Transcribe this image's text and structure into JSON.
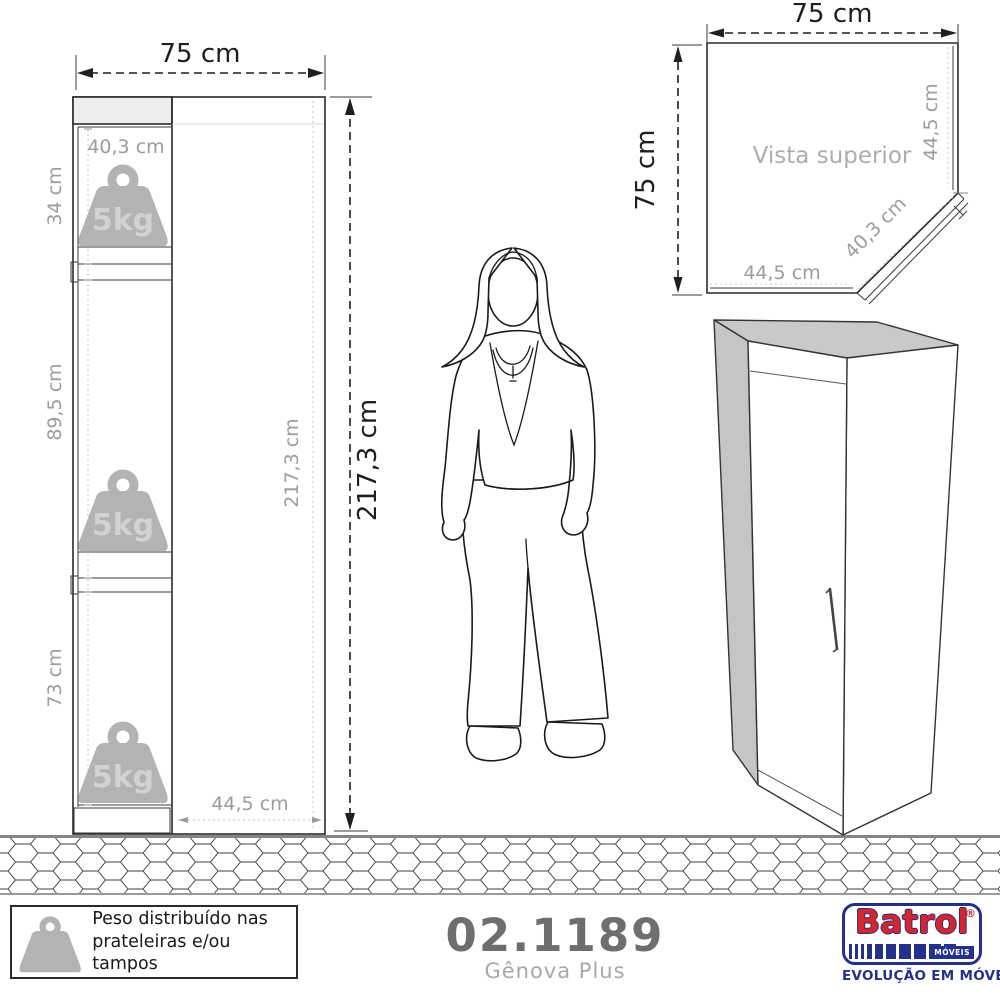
{
  "front_view": {
    "width_label": "75 cm",
    "height_label": "217,3 cm",
    "inner_height_label": "217,3 cm",
    "top_shelf_width_label": "40,3 cm",
    "bottom_width_label": "44,5 cm",
    "section_top_label": "34 cm",
    "section_middle_label": "89,5 cm",
    "section_bottom_label": "73 cm",
    "weight_label": "5kg"
  },
  "top_view": {
    "title": "Vista superior",
    "top_width_label": "75 cm",
    "left_depth_label": "75 cm",
    "right_side_label": "44,5 cm",
    "door_label": "40,3 cm",
    "bottom_side_label": "44,5 cm"
  },
  "legend": {
    "line1": "Peso distribuído nas",
    "line2": "prateleiras e/ou tampos"
  },
  "product": {
    "code": "02.1189",
    "name": "Gênova Plus"
  },
  "brand": {
    "name": "Batrol",
    "registered": "®",
    "label": "MÓVEIS",
    "tagline": "EVOLUÇÃO EM MÓVEIS"
  },
  "colors": {
    "line": "#2a2a2a",
    "gray_text": "#9c9c9c",
    "weight_gray": "#b3b3b3",
    "panel_gray": "#c6c6c6",
    "light_fill": "#ededed",
    "brand_red": "#d6252b",
    "brand_blue": "#23308c"
  }
}
